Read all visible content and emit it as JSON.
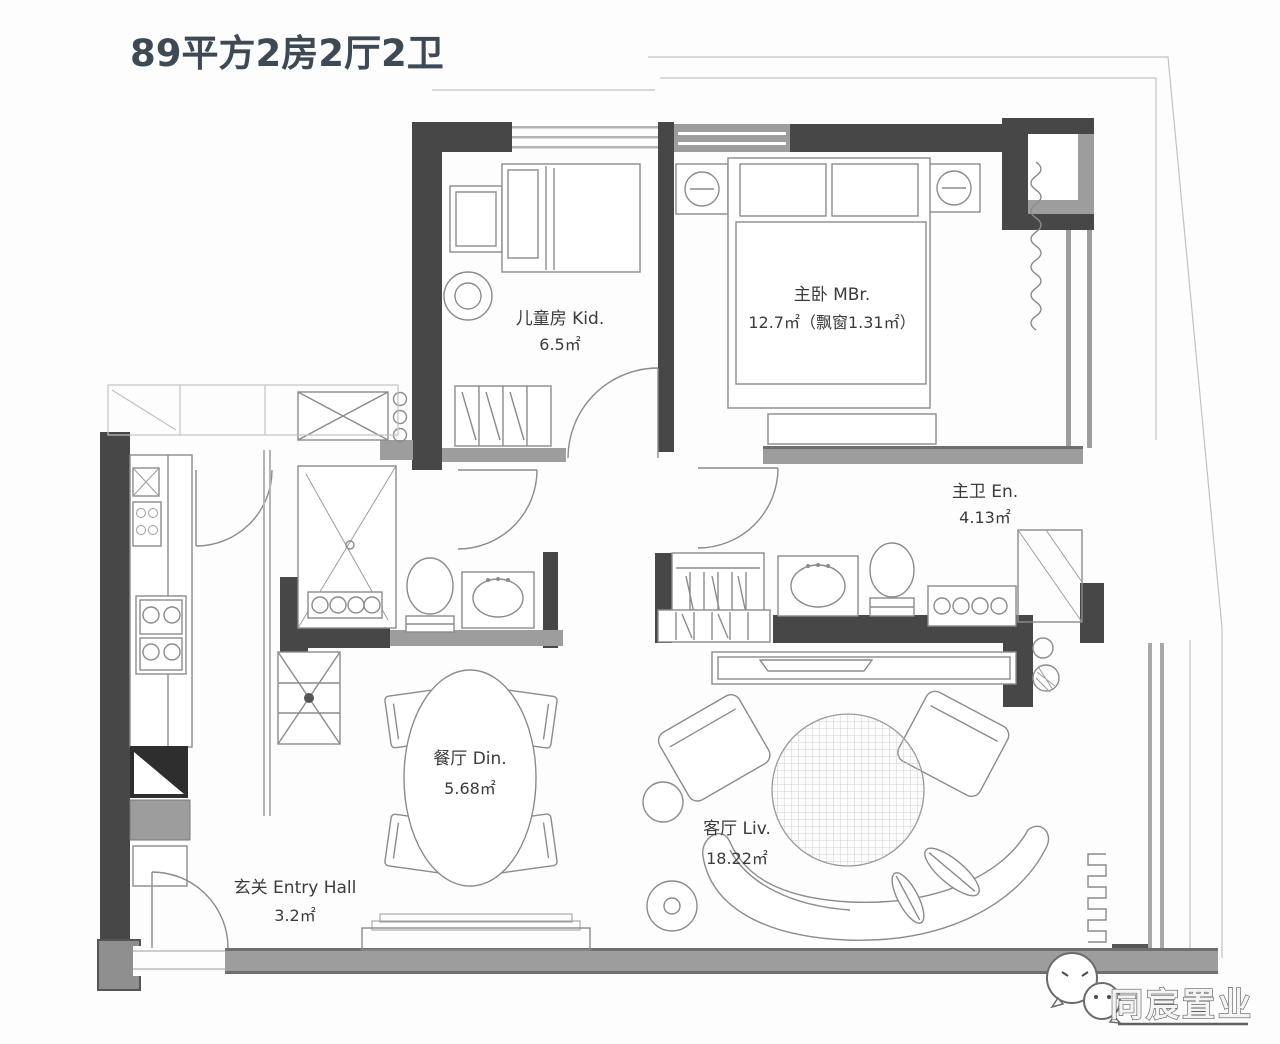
{
  "title": "89平方2房2厅2卫",
  "rooms": {
    "kid": {
      "line1": "儿童房 Kid.",
      "line2": "6.5㎡"
    },
    "master": {
      "line1": "主卧 MBr.",
      "line2": "12.7㎡（飘窗1.31㎡）"
    },
    "ensuite": {
      "line1": "主卫 En.",
      "line2": "4.13㎡"
    },
    "dining": {
      "line1": "餐厅 Din.",
      "line2": "5.68㎡"
    },
    "living": {
      "line1": "客厅 Liv.",
      "line2": "18.22㎡"
    },
    "entry": {
      "line1": "玄关 Entry Hall",
      "line2": "3.2㎡"
    }
  },
  "branding": {
    "logo_text": "同宸置业"
  },
  "colors": {
    "wall": "#474747",
    "window_band": "#9d9d9d",
    "sketch_stroke": "#8b8b8b",
    "title_color": "#3e4956",
    "background": "#fdfdfd"
  }
}
